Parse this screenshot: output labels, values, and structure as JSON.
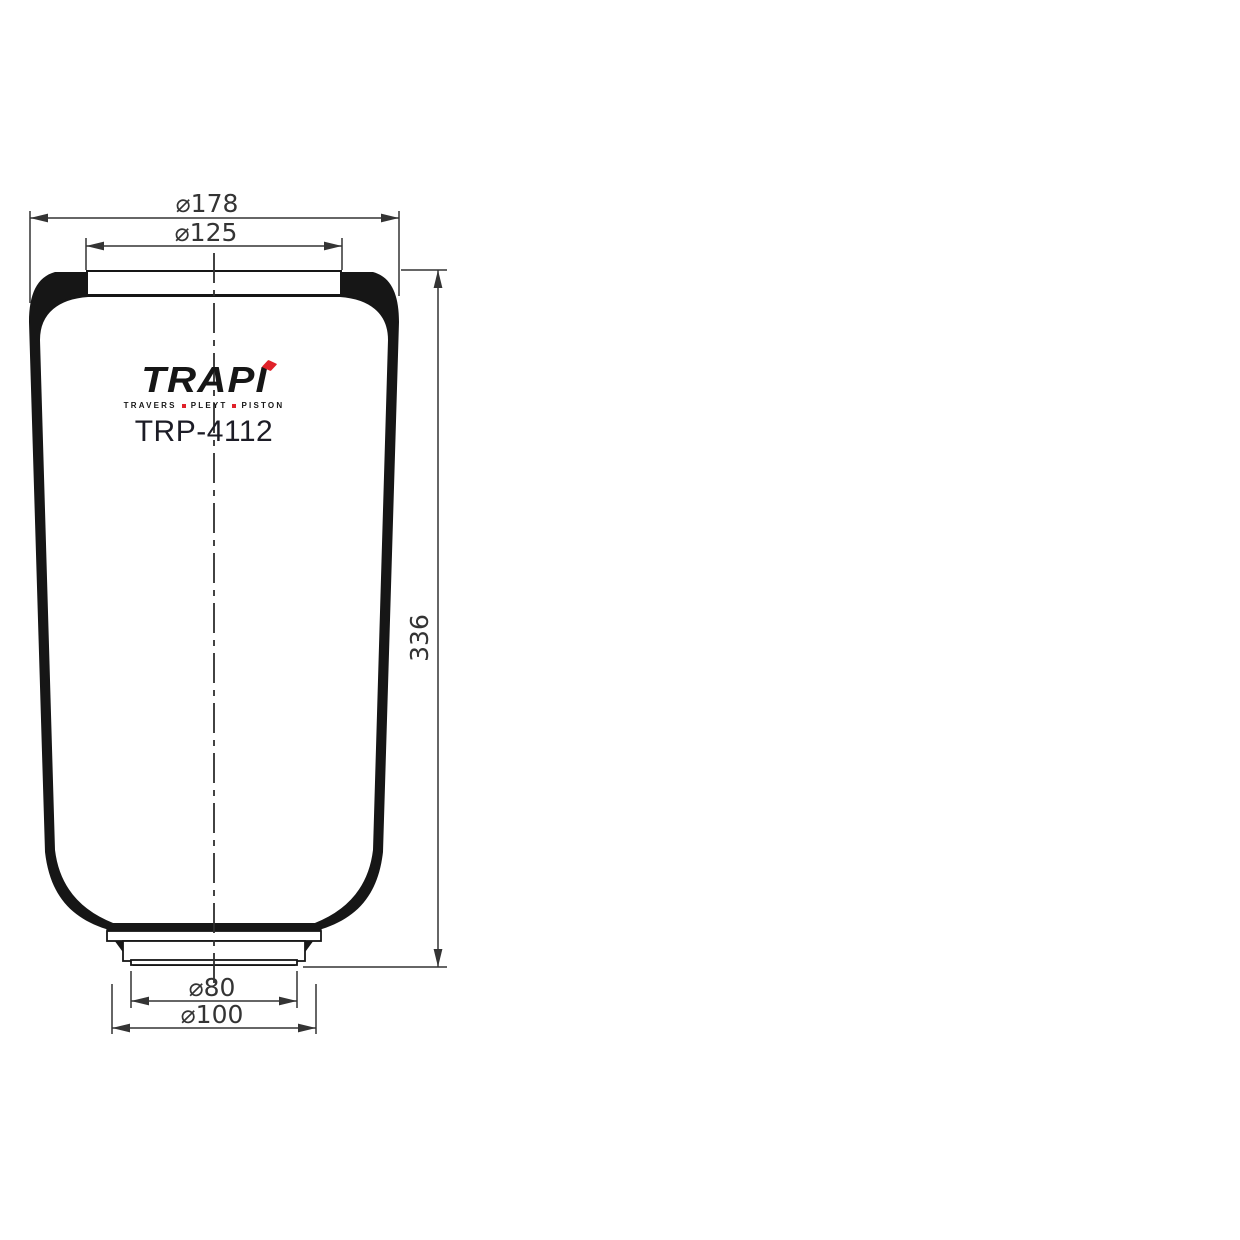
{
  "drawing": {
    "brand": {
      "name": "TRAPI",
      "tagline": [
        "TRAVERS",
        "PLEYT",
        "PISTON"
      ]
    },
    "part_number": "TRP-4112",
    "dimensions": {
      "top_outer_diameter": "⌀178",
      "top_bead_diameter": "⌀125",
      "overall_height": "336",
      "bottom_opening_diameter": "⌀80",
      "bottom_bead_diameter": "⌀100"
    },
    "colors": {
      "line": "#161616",
      "dimension": "#343434",
      "accent_red": "#e02129",
      "part_number_text": "#1c1c26",
      "background": "#ffffff"
    }
  }
}
